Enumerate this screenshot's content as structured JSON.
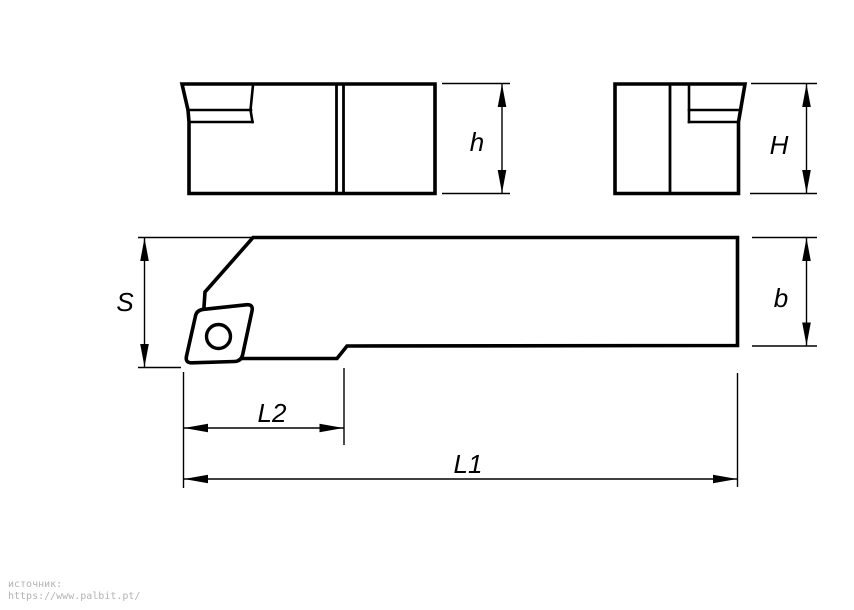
{
  "diagram": {
    "line_color": "#000000",
    "background_color": "#ffffff",
    "dimension_labels": {
      "h": "h",
      "H": "H",
      "S": "S",
      "b": "b",
      "L2": "L2",
      "L1": "L1"
    }
  },
  "source": {
    "caption": "источник:",
    "url": "https://www.palbit.pt/",
    "text_color": "#b3b3b3"
  }
}
